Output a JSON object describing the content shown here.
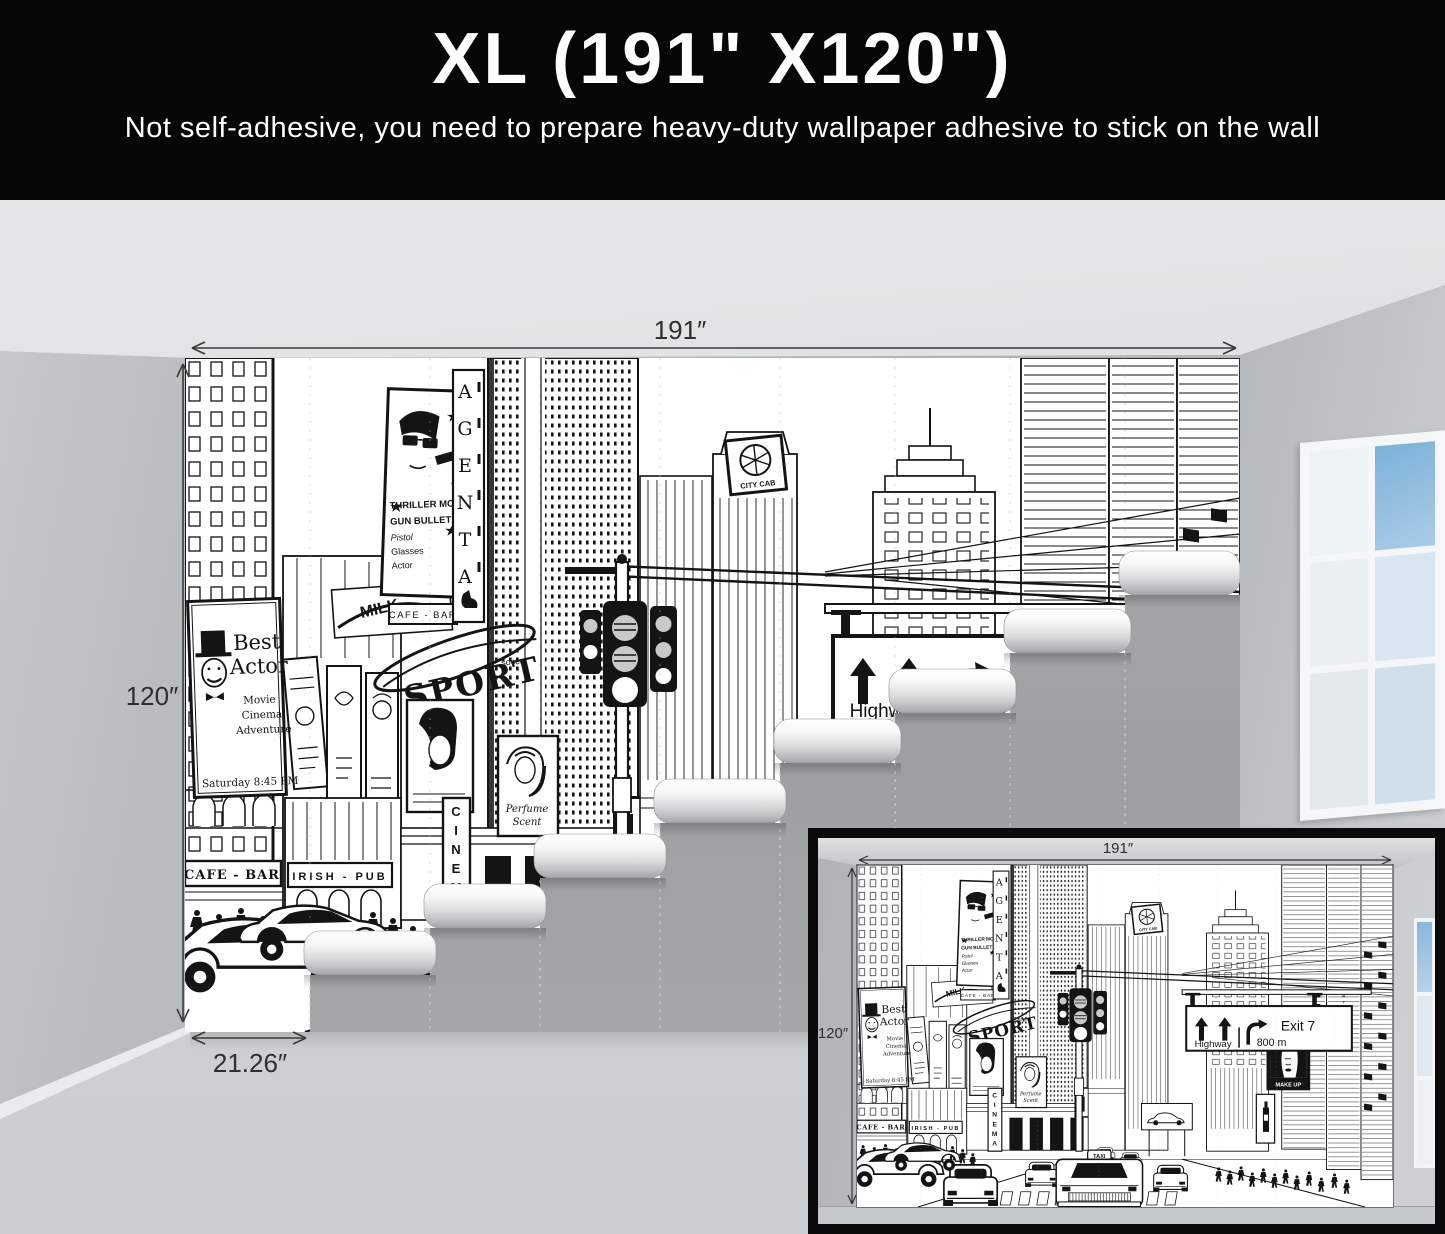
{
  "header": {
    "title": "XL (191\" X120\")",
    "subtitle": "Not self-adhesive, you need to prepare heavy-duty wallpaper adhesive to stick on the wall"
  },
  "main_view": {
    "width_label": "191″",
    "height_label": "120″",
    "panel_width_label": "21.26″"
  },
  "inset_view": {
    "width_label": "191″",
    "height_label": "120″"
  },
  "mural": {
    "best_actor": {
      "line1": "Best",
      "line2": "Actor",
      "line3": "Movie",
      "line4": "Cinema",
      "line5": "Adventure",
      "line6": "Saturday 8:45 PM"
    },
    "thriller": {
      "line1": "THRILLER MOVIE",
      "line2": "GUN BULLET",
      "line3": "Pistol",
      "line4": "Glasses",
      "line5": "Actor"
    },
    "agenta": "AGENTA",
    "cafe_bar": "CAFE - BAR",
    "cafe_bar_small": "CAFE - BAR",
    "irish_pub": "IRISH - PUB",
    "cinema": "CINEMA",
    "milk": "MILK",
    "sport": "SPORT",
    "soccer": "soccer",
    "perfume_line1": "Perfume",
    "perfume_line2": "Scent",
    "city_cab": "CITY CAB",
    "make_up": "MAKE UP",
    "art_museum": "ART MUSEUM",
    "taxi": "TAXI",
    "highway_sign": {
      "lane": "Highway",
      "exit": "Exit 7",
      "distance": "800 m"
    }
  },
  "colors": {
    "banner_bg": "#060606",
    "banner_text": "#ffffff",
    "bare_wall": "#a2a4a6",
    "room_wall": "#c0c3c5",
    "sky_pane": "#7db1d8",
    "ink": "#141414",
    "dimension_text": "#2f2f2f"
  }
}
